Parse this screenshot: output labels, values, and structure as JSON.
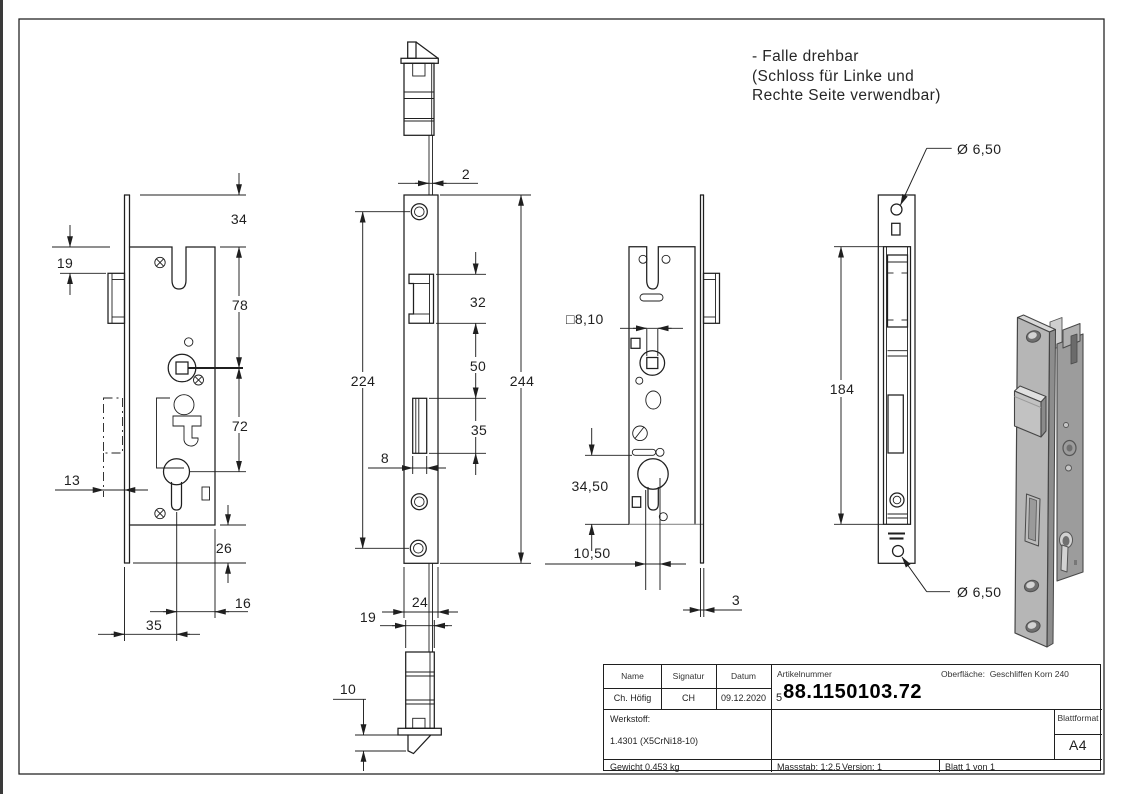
{
  "note": {
    "line1": "- Falle drehbar",
    "line2": "(Schloss für Linke und",
    "line3": "Rechte Seite verwendbar)"
  },
  "dimensions": {
    "view1": {
      "d34": "34",
      "d19": "19",
      "d78": "78",
      "d72": "72",
      "d13": "13",
      "d26": "26",
      "d16": "16",
      "d35": "35"
    },
    "view2": {
      "d2": "2",
      "d224": "224",
      "d244": "244",
      "d32": "32",
      "d50": "50",
      "d35": "35",
      "d8": "8",
      "d24": "24",
      "d19": "19",
      "d10": "10"
    },
    "view3": {
      "dsq": "□8,10",
      "d3450": "34,50",
      "d1050": "10,50",
      "d3": "3"
    },
    "view4": {
      "d184": "184",
      "d650top": "Ø 6,50",
      "d650bot": "Ø 6,50"
    }
  },
  "titleblock": {
    "name_label": "Name",
    "signatur_label": "Signatur",
    "datum_label": "Datum",
    "name": "Ch. Höfig",
    "signatur": "CH",
    "datum": "09.12.2020",
    "artikelnummer_label": "Artikelnummer",
    "artikelnummer_prefix": "5",
    "artikelnummer": "88.1150103.72",
    "oberflaeche_label": "Oberfläche:",
    "oberflaeche": "Geschliffen Korn 240",
    "werkstoff_label": "Werkstoff:",
    "werkstoff": "1.4301 (X5CrNi18-10)",
    "blattformat_label": "Blattformat",
    "blattformat": "A4",
    "gewicht": "Gewicht 0.453 kg",
    "massstab": "Massstab: 1:2.5",
    "version": "Version: 1",
    "blatt": "Blatt 1 von 1"
  }
}
